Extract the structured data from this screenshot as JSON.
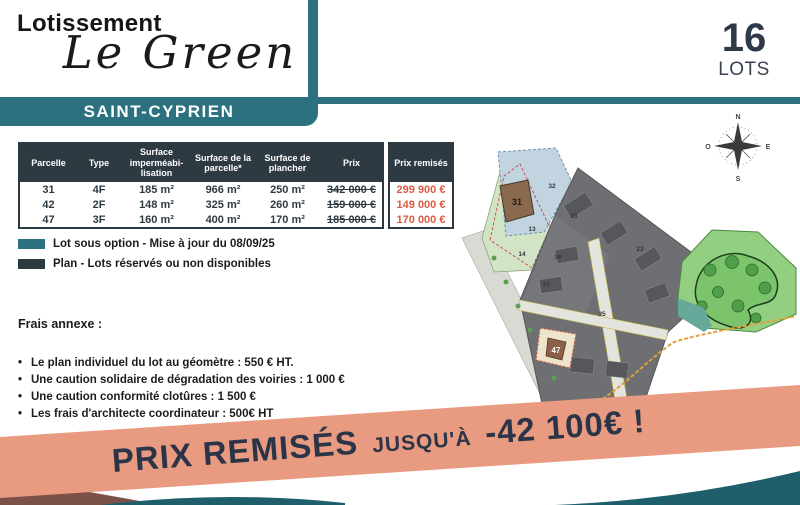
{
  "header": {
    "estate_label": "Lotissement",
    "estate_name": "Le Green",
    "city": "SAINT-CYPRIEN",
    "lots_count": "16",
    "lots_label": "LOTS"
  },
  "table": {
    "headers": {
      "parcelle": "Parcelle",
      "type": "Type",
      "surface_imp": "Surface imperméabi-lisation",
      "surface_parcelle": "Surface de la parcelle*",
      "surface_plancher": "Surface de plancher",
      "prix": "Prix",
      "prix_remises": "Prix remisés"
    },
    "rows": [
      {
        "parcelle": "31",
        "type": "4F",
        "surface_imp": "185 m²",
        "surface_parcelle": "966 m²",
        "surface_plancher": "250 m²",
        "prix": "342 000 €",
        "prix_remise": "299 900 €"
      },
      {
        "parcelle": "42",
        "type": "2F",
        "surface_imp": "148 m²",
        "surface_parcelle": "325 m²",
        "surface_plancher": "260 m²",
        "prix": "159 000 €",
        "prix_remise": "149 000 €"
      },
      {
        "parcelle": "47",
        "type": "3F",
        "surface_imp": "160 m²",
        "surface_parcelle": "400 m²",
        "surface_plancher": "170 m²",
        "prix": "185 000 €",
        "prix_remise": "170 000 €"
      }
    ]
  },
  "legend": {
    "option": {
      "label": "Lot sous option - Mise à jour du 08/09/25",
      "color": "#2b7180"
    },
    "reserved": {
      "label": "Plan - Lots réservés ou non disponibles",
      "color": "#2e3a42"
    }
  },
  "fees": {
    "title": "Frais annexe :",
    "items": [
      "Le plan individuel du lot au géomètre : 550 € HT.",
      "Une caution solidaire de dégradation des voiries : 1 000 €",
      "Une caution conformité clotûres : 1 500 €",
      "Les frais d'architecte coordinateur : 500€ HT"
    ]
  },
  "map": {
    "compass": {
      "n": "N",
      "s": "S",
      "e": "E",
      "o": "O"
    },
    "lot_labels": {
      "lot31": "31",
      "lot47": "47"
    },
    "plan_numbers": [
      "32",
      "33",
      "13",
      "14",
      "36",
      "15",
      "23",
      "35"
    ]
  },
  "banner": {
    "prefix": "PRIX REMISÉS",
    "middle": "JUSQU'À",
    "amount": "-42 100€ !"
  },
  "colors": {
    "teal": "#2b7180",
    "dark_slate": "#2e3a42",
    "price_red": "#dd5b41",
    "salmon": "#e89b80",
    "navy": "#2c3547",
    "wave_teal": "#1e5f6b"
  }
}
